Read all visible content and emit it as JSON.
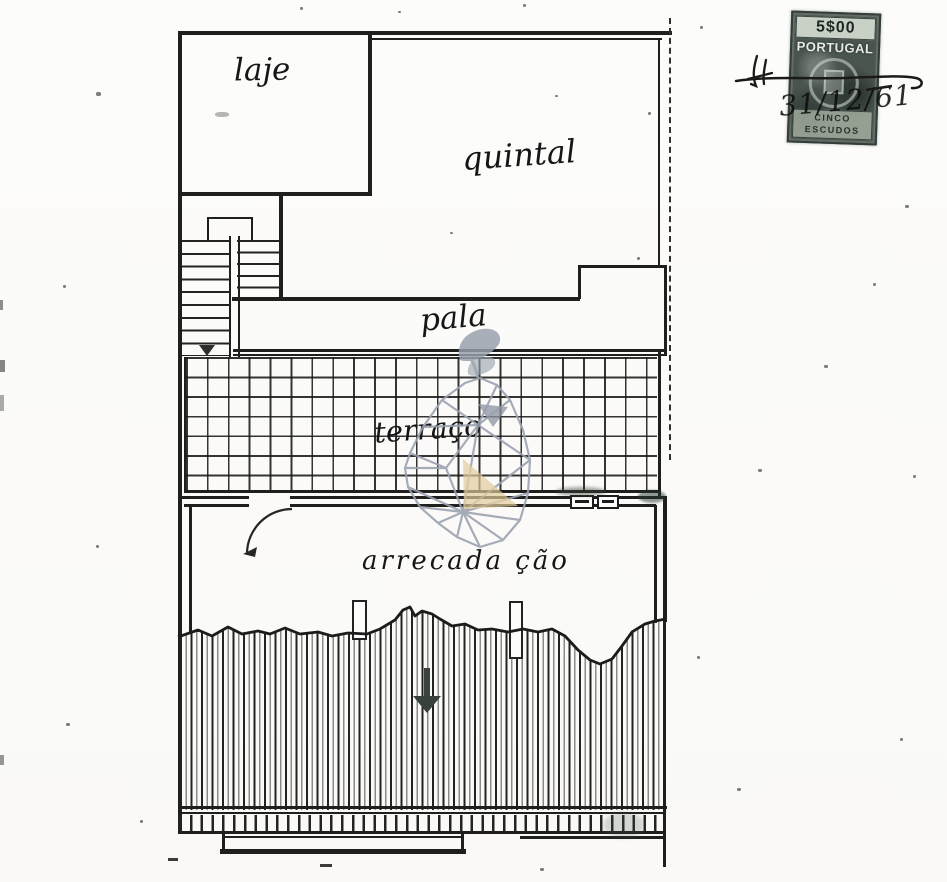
{
  "rooms": {
    "laje": "laje",
    "quintal": "quintal",
    "pala": "pala",
    "terraco": "terraço",
    "arrecadacao": "arrecada ção"
  },
  "stamp": {
    "value": "5$00",
    "country": "PORTUGAL",
    "denom1": "CINCO",
    "denom2": "ESCUDOS",
    "handwritten_date": "31/12/61"
  },
  "icons": {
    "stair_arrow": "down-arrow",
    "entrance_arrow": "down-arrow",
    "door_swing": "quarter-arc",
    "watermark": "pear-mesh-logo"
  },
  "colors": {
    "ink": "#1f1f1e",
    "paper": "#fbfbf9",
    "watermark_gray": "#9aa1ae",
    "watermark_tan": "#e0cb9a",
    "stamp_dark": "#4a554f"
  }
}
